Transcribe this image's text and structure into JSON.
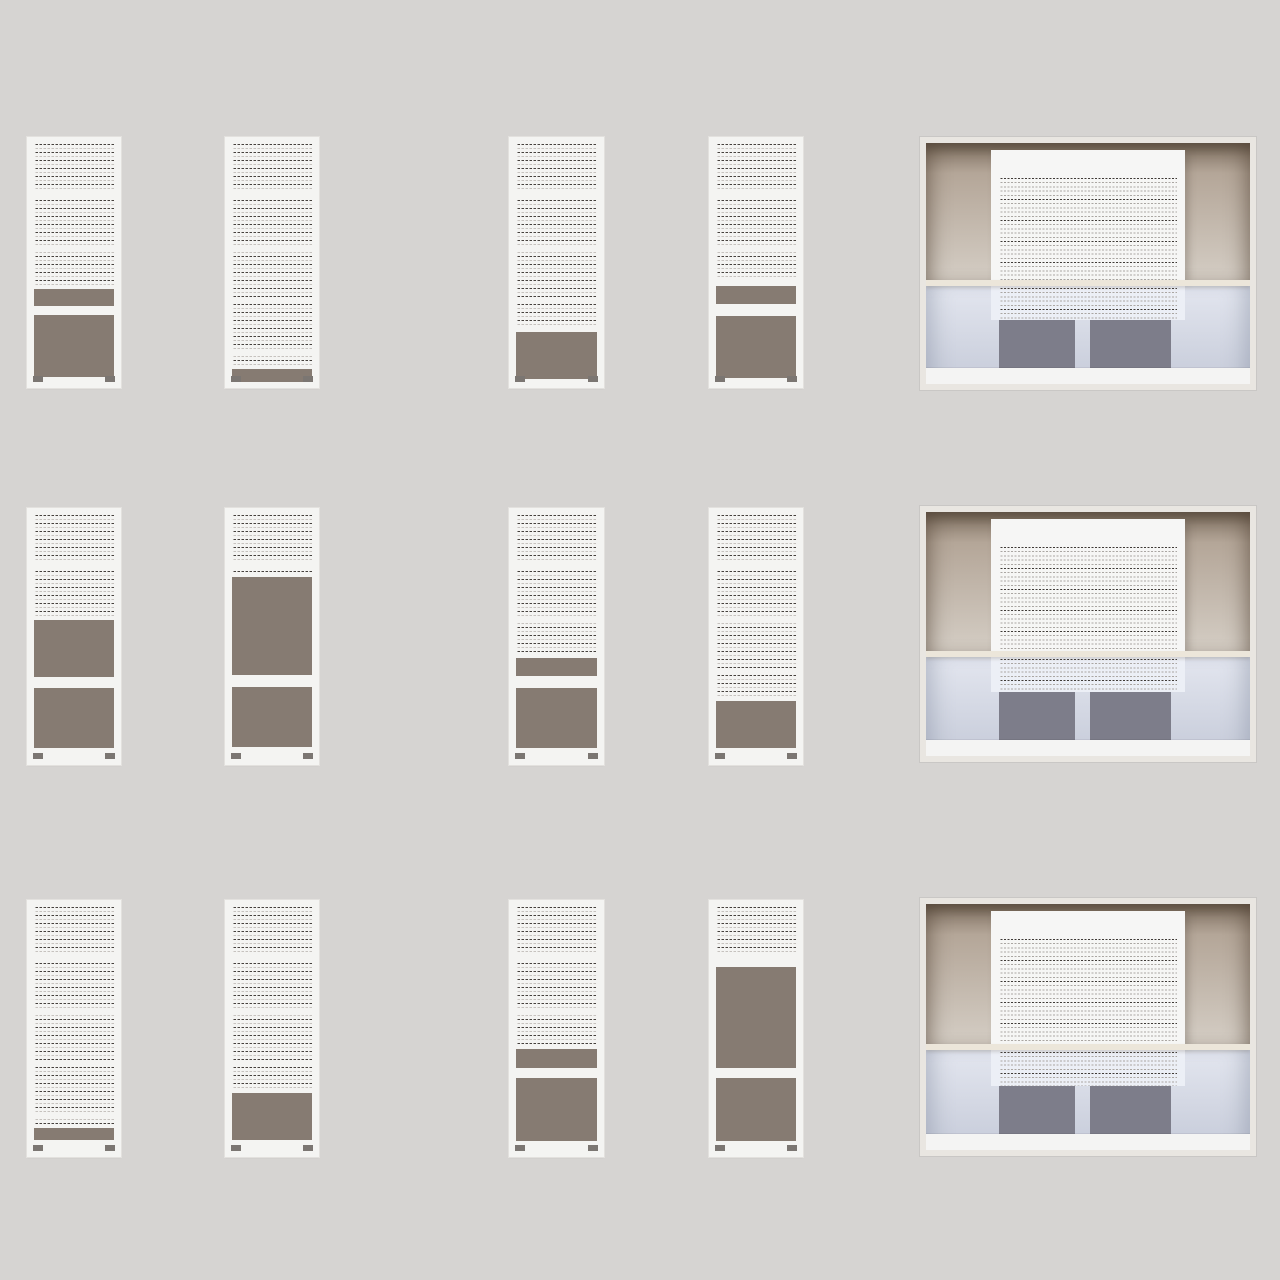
{
  "canvas": {
    "width": 1280,
    "height": 1280,
    "background": "#d6d4d2"
  },
  "palette": {
    "bg": "#d6d4d2",
    "card": "#f4f4f2",
    "card_border": "#e3e1de",
    "line_dark": "#45403c",
    "line_light": "#c6c2be",
    "taupe": "#867b72",
    "footer_mark": "#7b7672",
    "frame": "#e9e6e1",
    "wall_top": "#7f7061",
    "wall_mid": "#b4a698",
    "wall_bottom": "#d4cdc4",
    "shelf": "#ece6da",
    "glass_top": "#e3e6ef",
    "glass_bottom": "#c6cbd9",
    "sheet": "#f6f6f5",
    "sheet_tint": "#eceff6",
    "poster": "#7d7d8a",
    "sill": "#f4f4f3"
  },
  "storefront": {
    "frame_px": 6,
    "wall_ratio": 0.57,
    "shelf_h": 6,
    "sill_h": 16,
    "sheet": {
      "left": 65,
      "top": 7,
      "width": 194,
      "blank_top": 28
    },
    "posters": {
      "height": 48,
      "left": [
        73,
        164
      ],
      "width": [
        76,
        81
      ]
    }
  },
  "cards": [
    {
      "kind": "document",
      "row": 1,
      "col": 1,
      "x": 27,
      "y": 137,
      "w": 94,
      "h": 251,
      "segments": [
        [
          "text",
          141
        ],
        [
          "space",
          4
        ],
        [
          "bar",
          17
        ],
        [
          "space",
          9
        ],
        [
          "image",
          62
        ]
      ]
    },
    {
      "kind": "document",
      "row": 1,
      "col": 2,
      "x": 225,
      "y": 137,
      "w": 94,
      "h": 251,
      "segments": [
        [
          "text",
          222
        ],
        [
          "space",
          3
        ],
        [
          "bar",
          13
        ]
      ]
    },
    {
      "kind": "document",
      "row": 1,
      "col": 3,
      "x": 509,
      "y": 137,
      "w": 95,
      "h": 251,
      "segments": [
        [
          "text",
          183
        ],
        [
          "space",
          5
        ],
        [
          "image",
          47
        ]
      ]
    },
    {
      "kind": "document",
      "row": 1,
      "col": 4,
      "x": 709,
      "y": 137,
      "w": 94,
      "h": 251,
      "segments": [
        [
          "text",
          136
        ],
        [
          "space",
          6
        ],
        [
          "bar",
          18
        ],
        [
          "space",
          12
        ],
        [
          "image",
          62
        ]
      ]
    },
    {
      "kind": "storefront",
      "row": 1,
      "col": 5,
      "x": 920,
      "y": 137,
      "w": 336,
      "h": 253
    },
    {
      "kind": "document",
      "row": 2,
      "col": 1,
      "x": 27,
      "y": 508,
      "w": 94,
      "h": 257,
      "segments": [
        [
          "text",
          101
        ],
        [
          "space",
          4
        ],
        [
          "image",
          57
        ],
        [
          "space",
          11
        ],
        [
          "image",
          60
        ]
      ]
    },
    {
      "kind": "document",
      "row": 2,
      "col": 2,
      "x": 225,
      "y": 508,
      "w": 94,
      "h": 257,
      "segments": [
        [
          "text",
          58
        ],
        [
          "space",
          4
        ],
        [
          "image",
          98
        ],
        [
          "space",
          12
        ],
        [
          "image",
          60
        ]
      ]
    },
    {
      "kind": "document",
      "row": 2,
      "col": 3,
      "x": 509,
      "y": 508,
      "w": 95,
      "h": 257,
      "segments": [
        [
          "text",
          138
        ],
        [
          "space",
          5
        ],
        [
          "bar",
          18
        ],
        [
          "space",
          12
        ],
        [
          "image",
          60
        ]
      ]
    },
    {
      "kind": "document",
      "row": 2,
      "col": 4,
      "x": 709,
      "y": 508,
      "w": 94,
      "h": 257,
      "segments": [
        [
          "text",
          183
        ],
        [
          "space",
          3
        ],
        [
          "image",
          47
        ]
      ]
    },
    {
      "kind": "storefront",
      "row": 2,
      "col": 5,
      "x": 920,
      "y": 506,
      "w": 336,
      "h": 256
    },
    {
      "kind": "document",
      "row": 3,
      "col": 1,
      "x": 27,
      "y": 900,
      "w": 94,
      "h": 257,
      "segments": [
        [
          "text",
          219
        ],
        [
          "space",
          2
        ],
        [
          "bar",
          12
        ]
      ]
    },
    {
      "kind": "document",
      "row": 3,
      "col": 2,
      "x": 225,
      "y": 900,
      "w": 94,
      "h": 257,
      "segments": [
        [
          "text",
          181
        ],
        [
          "space",
          5
        ],
        [
          "image",
          47
        ]
      ]
    },
    {
      "kind": "document",
      "row": 3,
      "col": 3,
      "x": 509,
      "y": 900,
      "w": 95,
      "h": 257,
      "segments": [
        [
          "text",
          138
        ],
        [
          "space",
          4
        ],
        [
          "bar",
          19
        ],
        [
          "space",
          10
        ],
        [
          "image",
          63
        ]
      ]
    },
    {
      "kind": "document",
      "row": 3,
      "col": 4,
      "x": 709,
      "y": 900,
      "w": 94,
      "h": 257,
      "segments": [
        [
          "text",
          55
        ],
        [
          "space",
          5
        ],
        [
          "image",
          101
        ],
        [
          "space",
          10
        ],
        [
          "image",
          63
        ]
      ]
    },
    {
      "kind": "storefront",
      "row": 3,
      "col": 5,
      "x": 920,
      "y": 898,
      "w": 336,
      "h": 258
    }
  ]
}
